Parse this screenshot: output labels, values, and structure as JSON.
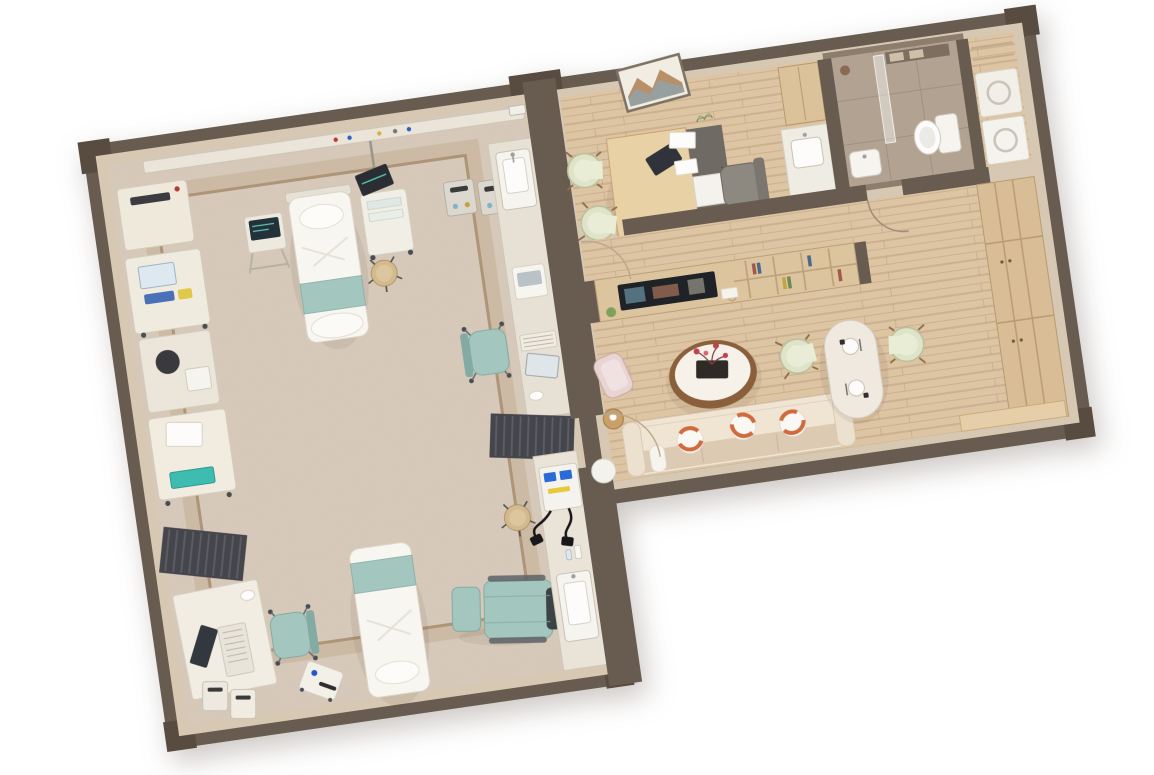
{
  "scene": {
    "title": "3D cutaway dollhouse floor-plan rendering of a medical clinic suite with attached office, bathroom and family lounge",
    "view": "top-down isometric render rotated about 8 degrees, white background",
    "background": "#ffffff"
  },
  "palette": {
    "wall-dark": "#685c50",
    "wall-darker": "#584c41",
    "wall-face": "#d7c8b3",
    "floor-spec": "#d8cbbc",
    "floor-border": "#c6b29a",
    "inlay": "#a78c6c",
    "wood-floor": "#ddc4a2",
    "bath-wall": "#8d7d6d",
    "bath-floor": "#b2a292",
    "white-furn": "#f4f1ea",
    "teal": "#a3c6be",
    "teal-dark": "#84aba3",
    "pale-green": "#dfe4c8",
    "pale-green-dark": "#b9c09c",
    "sofa": "#f0e4d3",
    "sofa-dark": "#ddcab2",
    "orange": "#cf6b3e",
    "wood-desk": "#e9d1a6",
    "wood-ward": "#d8bd97",
    "grey-chair": "#8d8880",
    "dark": "#34383c",
    "slat": "#45454c",
    "blush": "#e8d4d2",
    "tan": "#d2b98e",
    "screen-blue": "#2b6bd8"
  },
  "rooms": [
    {
      "id": "treatment-room",
      "label": "Treatment room",
      "floor": "speckled beige vinyl with double tan border inlay",
      "items": [
        "wall equipment rail with power outlets",
        "hospital bed with teal runner (top)",
        "hospital bed with teal runner (bottom)",
        "portable monitor cart",
        "folding monitor stand",
        "grey waste bins x2 (top wall)",
        "sink counter with basin",
        "nurse workstation with monitor and keyboard",
        "teal swivel chair x2",
        "medical device machines x4 along left wall",
        "dark slatted privacy screens x2",
        "corner desk with monitor (bottom-left)",
        "white waste bins x2 (bottom-left)",
        "portable therapy device cart",
        "teal exam recliner with dark head pillow",
        "round tan stools x2",
        "long counter with ECG unit, cables and second sink"
      ]
    },
    {
      "id": "consult-office",
      "label": "Consultation office",
      "floor": "light wood planks",
      "items": [
        "curved light-wood desk",
        "grey privacy return panel",
        "desktop monitor",
        "grey office chair",
        "pale-green guest chairs x2",
        "framed mountain wall art",
        "sink counter",
        "tall wood cabinet",
        "door opening to hallway"
      ]
    },
    {
      "id": "bathroom",
      "label": "Bathroom",
      "floor": "grey-taupe stone tile",
      "items": [
        "glass shower partition",
        "toilet",
        "washbasin",
        "shelf niches",
        "door opening"
      ]
    },
    {
      "id": "utility-closet",
      "label": "Utility closet",
      "floor": "light wood",
      "items": [
        "stacked white appliances x2",
        "open shelving"
      ]
    },
    {
      "id": "hallway",
      "label": "Hallway",
      "floor": "light wood planks",
      "items": [
        "door swing arcs",
        "passage linking office, bathroom and lounge"
      ]
    },
    {
      "id": "living-room",
      "label": "Family lounge",
      "floor": "light wood planks",
      "items": [
        "media shelving wall with TV, books and plant",
        "round coffee table with red flower centerpiece on black tray",
        "cream sofa with white-and-orange striped round pillows",
        "blush lounge chair",
        "round wood side table with cup",
        "white dining table with two place settings",
        "pale-green dining chairs x2",
        "wardrobe wall with door seams",
        "window bench",
        "round white side table at doorway"
      ]
    }
  ]
}
